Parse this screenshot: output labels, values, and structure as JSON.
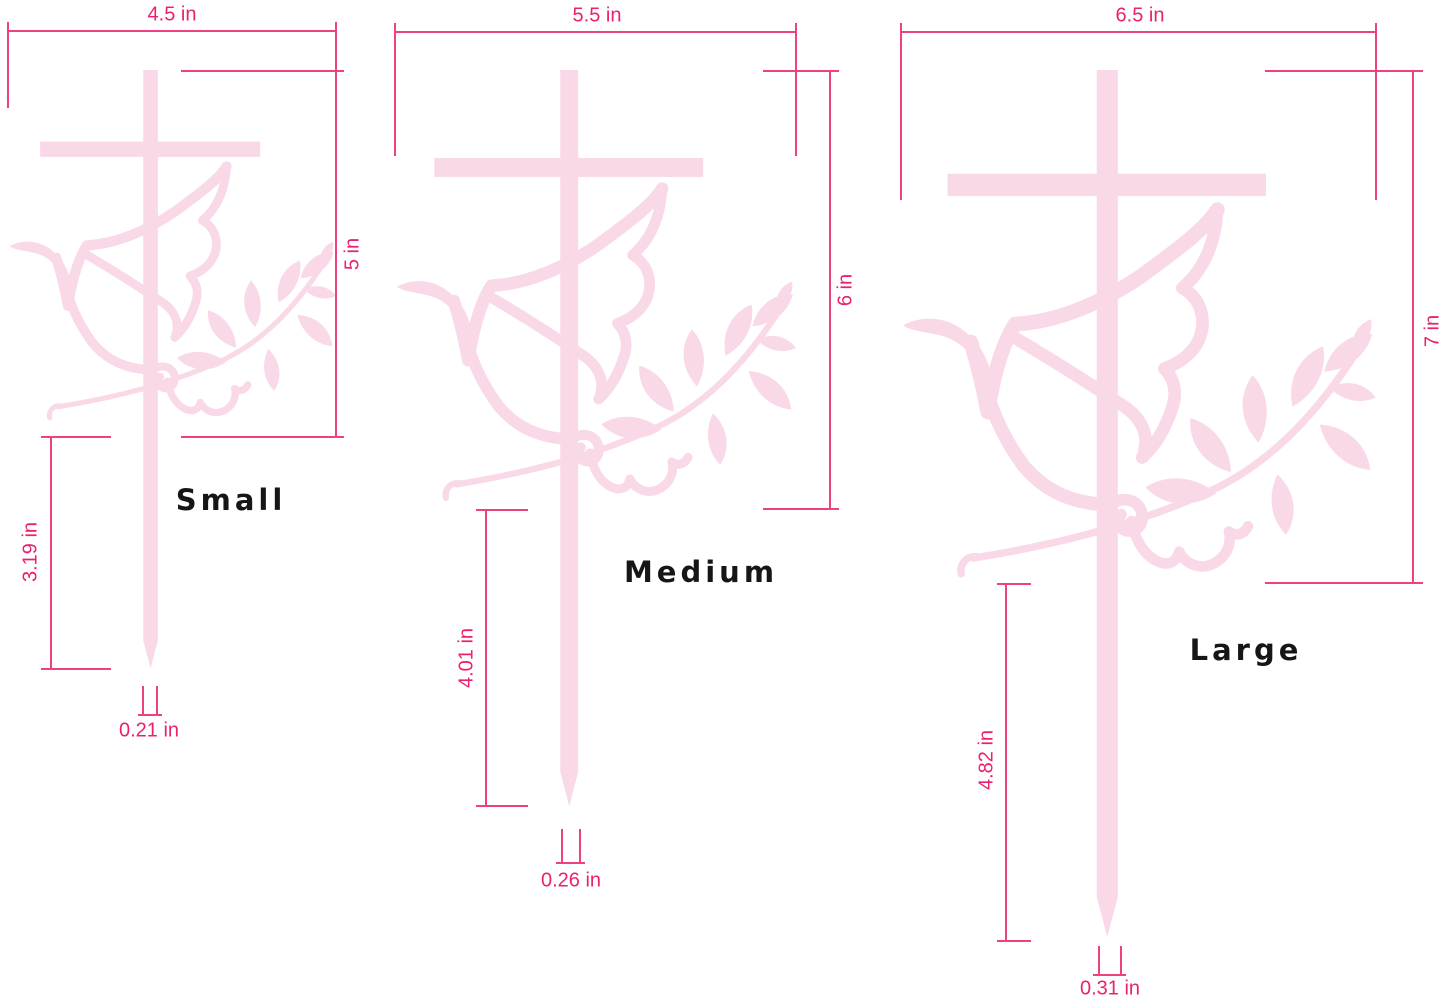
{
  "artwork": {
    "icon": "cross-with-dove-and-olive-branch",
    "art_color": "#F9D9E7",
    "dim_line_color": "#EF4181",
    "dim_text_color": "#EB2170",
    "label_color": "#161616"
  },
  "figures": [
    {
      "id": "small",
      "label": "Small",
      "width_label": "4.5 in",
      "height_label": "5 in",
      "stake_label": "3.19 in",
      "tip_label": "0.21 in",
      "width_in": 4.5,
      "height_in": 5,
      "stake_in": 3.19,
      "stake_width_in": 0.21
    },
    {
      "id": "medium",
      "label": "Medium",
      "width_label": "5.5 in",
      "height_label": "6 in",
      "stake_label": "4.01 in",
      "tip_label": "0.26 in",
      "width_in": 5.5,
      "height_in": 6,
      "stake_in": 4.01,
      "stake_width_in": 0.26
    },
    {
      "id": "large",
      "label": "Large",
      "width_label": "6.5 in",
      "height_label": "7 in",
      "stake_label": "4.82 in",
      "tip_label": "0.31 in",
      "width_in": 6.5,
      "height_in": 7,
      "stake_in": 4.82,
      "stake_width_in": 0.31
    }
  ]
}
